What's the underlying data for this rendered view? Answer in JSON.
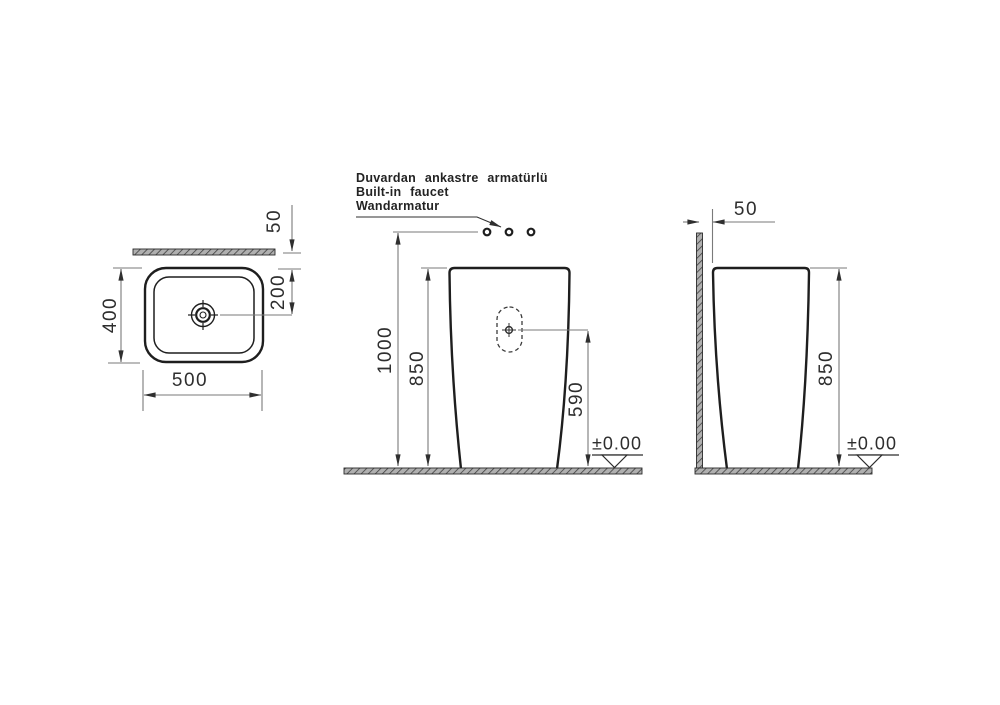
{
  "note": {
    "l1": "Duvardan ankastre armatürlü",
    "l2": "Built-in faucet",
    "l3": "Wandarmatur"
  },
  "top_view": {
    "width_label": "500",
    "depth_label": "400",
    "drain_offset_label": "200",
    "wall_gap_label": "50"
  },
  "front_view": {
    "faucet_height_label": "1000",
    "rim_height_label": "850",
    "drain_height_label": "590",
    "level_label": "±0.00"
  },
  "side_view": {
    "wall_gap_label": "50",
    "rim_height_label": "850",
    "level_label": "±0.00"
  },
  "colors": {
    "object_line": "#1e1e1e",
    "dimension_line": "#7a7a7a",
    "hatch_fill": "#b0b0b0",
    "hatch_stroke": "#3f3f3f"
  }
}
